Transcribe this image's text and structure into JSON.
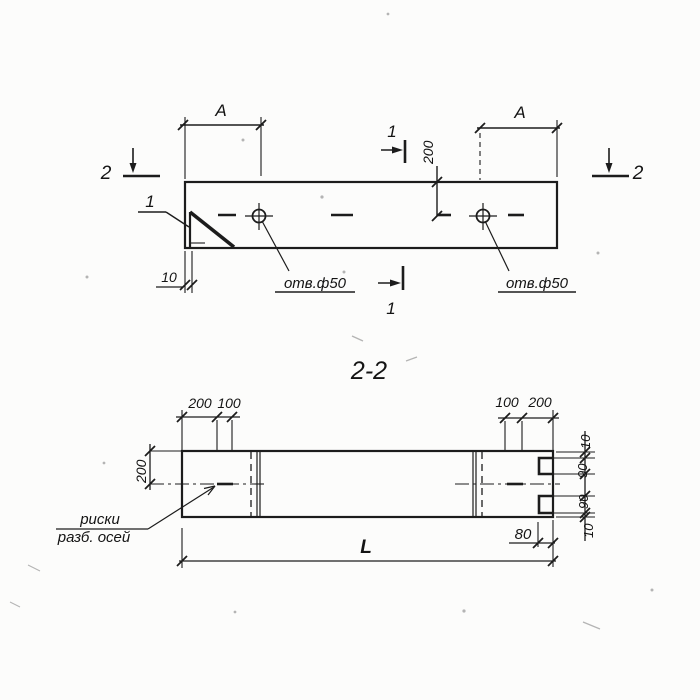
{
  "drawing": {
    "kind": "beam reinforced-concrete element, plan and section, GOST-style working drawing"
  },
  "plan": {
    "span": "А",
    "hole_offset": "200",
    "edge": "10",
    "hole_note": "отв.ф50",
    "cut_1": "1",
    "cut_2": "2",
    "callout": "1"
  },
  "section": {
    "title": "2-2",
    "top_left": {
      "a": "200",
      "b": "100"
    },
    "top_right": {
      "a": "100",
      "b": "200"
    },
    "height": "200",
    "right_chain": [
      "10",
      "90",
      "90",
      "10"
    ],
    "notch_depth": "80",
    "length": "L",
    "note": {
      "line1": "риски",
      "line2": "разб. осей"
    }
  },
  "colors": {
    "ink": "#1c1c1c",
    "paper": "#fcfcfb"
  }
}
